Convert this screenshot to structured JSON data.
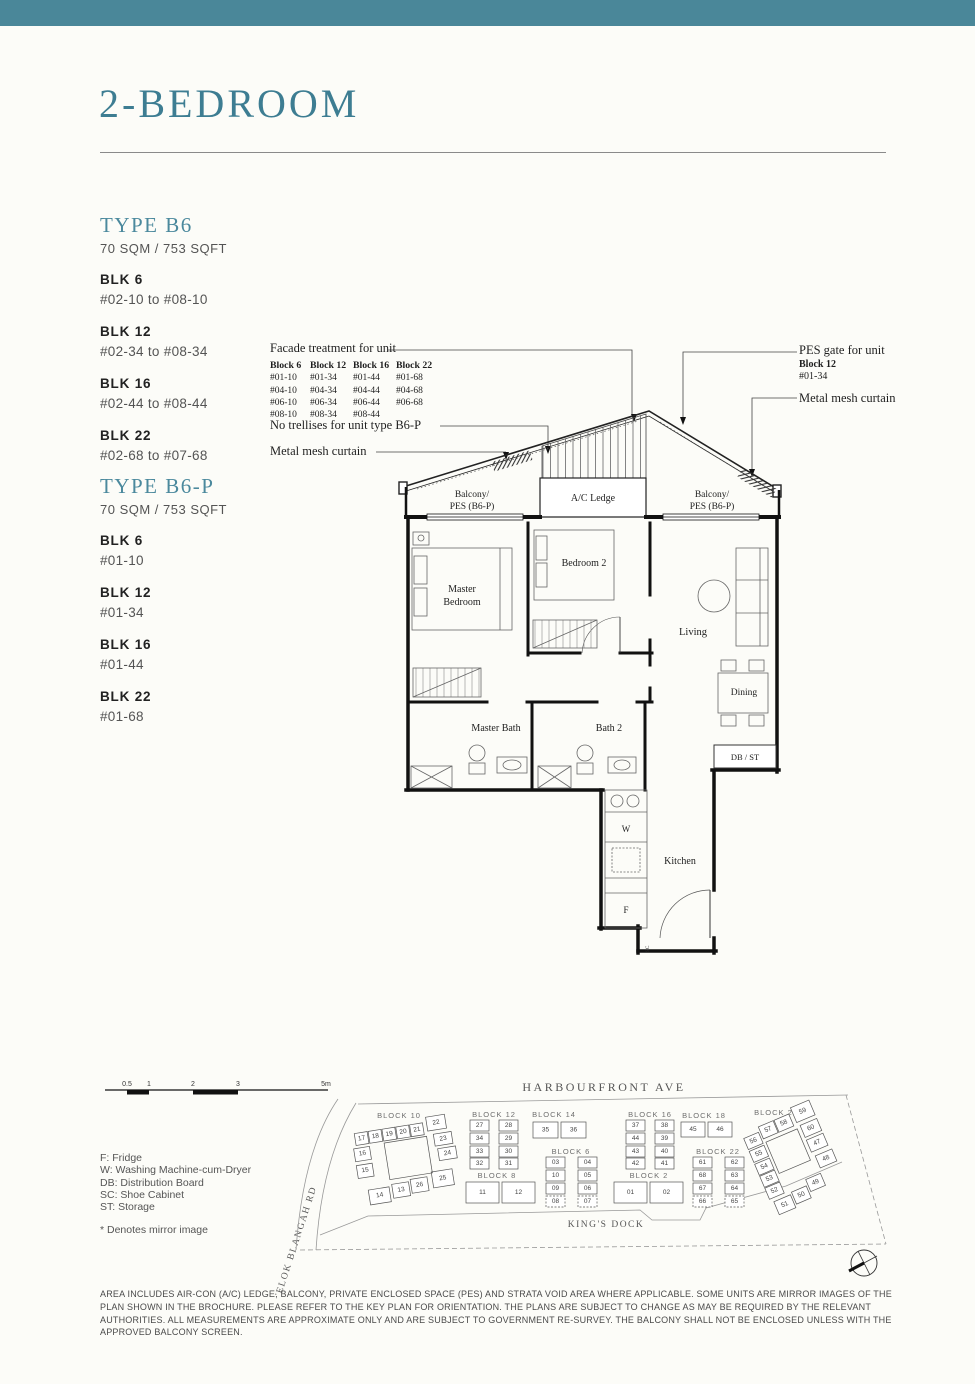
{
  "page": {
    "title": "2-BEDROOM"
  },
  "colors": {
    "accent_teal": "#4a8799",
    "title_teal": "#3d7d92",
    "unit_highlight": "#b4dbe9"
  },
  "sidebar": {
    "b6": {
      "heading": "TYPE B6",
      "area": "70 SQM / 753 SQFT",
      "blocks": [
        {
          "name": "BLK 6",
          "range": "#02-10 to #08-10"
        },
        {
          "name": "BLK 12",
          "range": "#02-34 to #08-34"
        },
        {
          "name": "BLK 16",
          "range": "#02-44 to #08-44"
        },
        {
          "name": "BLK 22",
          "range": "#02-68 to #07-68"
        }
      ]
    },
    "b6p": {
      "heading": "TYPE B6-P",
      "area": "70 SQM / 753 SQFT",
      "blocks": [
        {
          "name": "BLK 6",
          "range": "#01-10"
        },
        {
          "name": "BLK 12",
          "range": "#01-34"
        },
        {
          "name": "BLK 16",
          "range": "#01-44"
        },
        {
          "name": "BLK 22",
          "range": "#01-68"
        }
      ]
    }
  },
  "annotations": {
    "facade": {
      "label": "Facade treatment for unit",
      "headers": [
        "Block 6",
        "Block 12",
        "Block 16",
        "Block 22"
      ],
      "rows": [
        [
          "#01-10",
          "#01-34",
          "#01-44",
          "#01-68"
        ],
        [
          "#04-10",
          "#04-34",
          "#04-44",
          "#04-68"
        ],
        [
          "#06-10",
          "#06-34",
          "#06-44",
          "#06-68"
        ],
        [
          "#08-10",
          "#08-34",
          "#08-44",
          ""
        ]
      ]
    },
    "no_trellis": "No trellises for unit type B6-P",
    "mesh_left": "Metal mesh curtain",
    "pes_gate": {
      "l1": "PES gate for unit",
      "l2": "Block 12",
      "l3": "#01-34"
    },
    "mesh_right": "Metal mesh curtain"
  },
  "plan": {
    "balcony1": "Balcony/",
    "balcony2": "PES (B6-P)",
    "ac_ledge": "A/C Ledge",
    "master1": "Master",
    "master2": "Bedroom",
    "bedroom2": "Bedroom 2",
    "living": "Living",
    "dining": "Dining",
    "master_bath": "Master Bath",
    "bath2": "Bath 2",
    "db_st": "DB / ST",
    "kitchen": "Kitchen",
    "w": "W",
    "f": "F",
    "sc": "SC"
  },
  "siteplan": {
    "scale": {
      "ticks": [
        "0.5",
        "1",
        "2",
        "3",
        "5m"
      ]
    },
    "streets": {
      "top": "HARBOURFRONT AVE",
      "left": "TELOK BLANGAH RD",
      "bottom": "KING'S DOCK"
    },
    "blocks": {
      "b10": {
        "label": "BLOCK 10",
        "units": [
          "17",
          "18",
          "19",
          "20",
          "21",
          "22",
          "23",
          "24",
          "25",
          "26",
          "13",
          "14",
          "15",
          "16"
        ]
      },
      "b12": {
        "label": "BLOCK 12",
        "units": [
          "27",
          "28",
          "34",
          "29",
          "33",
          "30",
          "32",
          "31"
        ]
      },
      "b14": {
        "label": "BLOCK 14",
        "units": [
          "35",
          "36"
        ]
      },
      "b16": {
        "label": "BLOCK 16",
        "units": [
          "37",
          "38",
          "44",
          "39",
          "43",
          "40",
          "42",
          "41"
        ]
      },
      "b18": {
        "label": "BLOCK 18",
        "units": [
          "45",
          "46"
        ]
      },
      "b20": {
        "label": "BLOCK 20",
        "units": [
          "56",
          "55",
          "54",
          "53",
          "52",
          "51",
          "57",
          "58",
          "59",
          "60",
          "47",
          "48",
          "50",
          "49"
        ]
      },
      "b8": {
        "label": "BLOCK 8",
        "units": [
          "11",
          "12"
        ]
      },
      "b6": {
        "label": "BLOCK 6",
        "units": [
          "03",
          "04",
          "10",
          "05",
          "09",
          "06",
          "08",
          "07"
        ]
      },
      "b2": {
        "label": "BLOCK 2",
        "units": [
          "01",
          "02"
        ]
      },
      "b22": {
        "label": "BLOCK 22",
        "units": [
          "61",
          "62",
          "68",
          "63",
          "67",
          "64",
          "66",
          "65"
        ]
      }
    }
  },
  "legend": {
    "items": [
      "F: Fridge",
      "W: Washing Machine-cum-Dryer",
      "DB: Distribution Board",
      "SC: Shoe Cabinet",
      "ST: Storage"
    ],
    "note": "* Denotes mirror image"
  },
  "disclaimer": "AREA INCLUDES AIR-CON (A/C) LEDGE, BALCONY, PRIVATE ENCLOSED SPACE (PES) AND STRATA VOID AREA WHERE APPLICABLE. SOME UNITS ARE MIRROR IMAGES OF THE PLAN SHOWN IN THE BROCHURE. PLEASE REFER TO THE KEY PLAN FOR ORIENTATION. THE PLANS ARE SUBJECT TO CHANGE AS MAY BE REQUIRED BY THE RELEVANT AUTHORITIES. ALL MEASUREMENTS ARE APPROXIMATE ONLY AND ARE SUBJECT TO GOVERNMENT RE-SURVEY. THE BALCONY SHALL NOT BE ENCLOSED UNLESS WITH THE APPROVED BALCONY SCREEN."
}
